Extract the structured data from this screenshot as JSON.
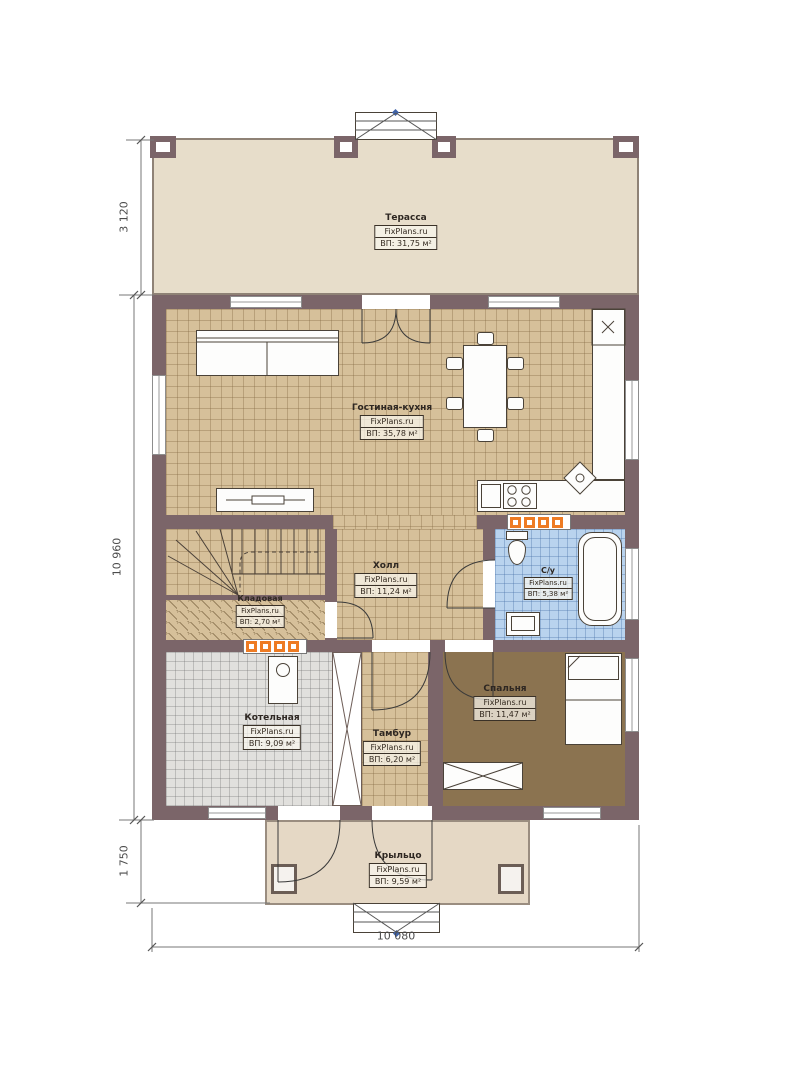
{
  "watermark": "FixPlans.ru",
  "rooms": [
    {
      "id": "terrace",
      "name": "Терасса",
      "area": "ВП: 31,75 м²"
    },
    {
      "id": "living",
      "name": "Гостиная-кухня",
      "area": "ВП: 35,78 м²"
    },
    {
      "id": "hall",
      "name": "Холл",
      "area": "ВП: 11,24 м²"
    },
    {
      "id": "wc",
      "name": "С/у",
      "area": "ВП: 5,38 м²"
    },
    {
      "id": "storage",
      "name": "Кладовая",
      "area": "ВП: 2,70 м²"
    },
    {
      "id": "boiler",
      "name": "Котельная",
      "area": "ВП: 9,09 м²"
    },
    {
      "id": "tambour",
      "name": "Тамбур",
      "area": "ВП: 6,20 м²"
    },
    {
      "id": "bedroom",
      "name": "Спальня",
      "area": "ВП: 11,47 м²"
    },
    {
      "id": "porch",
      "name": "Крыльцо",
      "area": "ВП: 9,59 м²"
    }
  ],
  "dimensions": {
    "left_top": "3 120",
    "left_middle": "10 960",
    "left_bottom": "1 750",
    "bottom": "10 080"
  },
  "colors": {
    "wall": "#7b6569",
    "tile": "#d6c09a",
    "bath": "#b9d3ee",
    "boiler": "#e1e0dd",
    "bedroom": "#8b7350",
    "terrace": "#e7ddca",
    "porch": "#e5d8c5",
    "radiator": "#ee7b23"
  }
}
